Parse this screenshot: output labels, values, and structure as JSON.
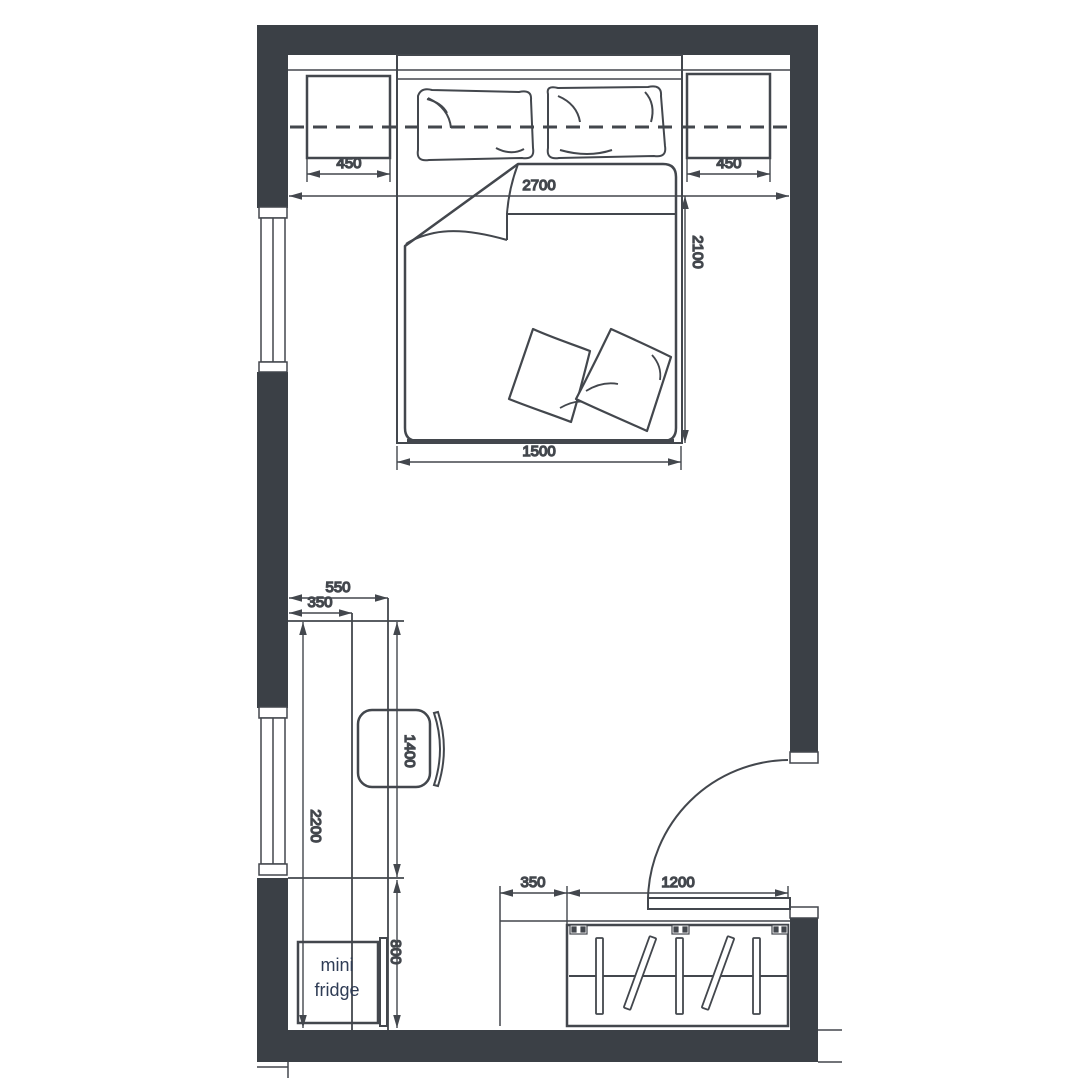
{
  "colors": {
    "background": "#ffffff",
    "wall_fill": "#3b4046",
    "line": "#43474d",
    "dim_text": "#3d4a66"
  },
  "fridge": {
    "label_line1": "mini",
    "label_line2": "fridge"
  },
  "dimensions": {
    "nightstand_left": "450",
    "nightstand_right": "450",
    "room_width": "2700",
    "bed_length": "2100",
    "bed_width": "1500",
    "desk_zone_depth": "550",
    "desk_depth": "350",
    "desk_length": "1400",
    "left_wall_run": "2200",
    "fridge_nook": "800",
    "wardrobe_side": "350",
    "wardrobe_width": "1200"
  }
}
